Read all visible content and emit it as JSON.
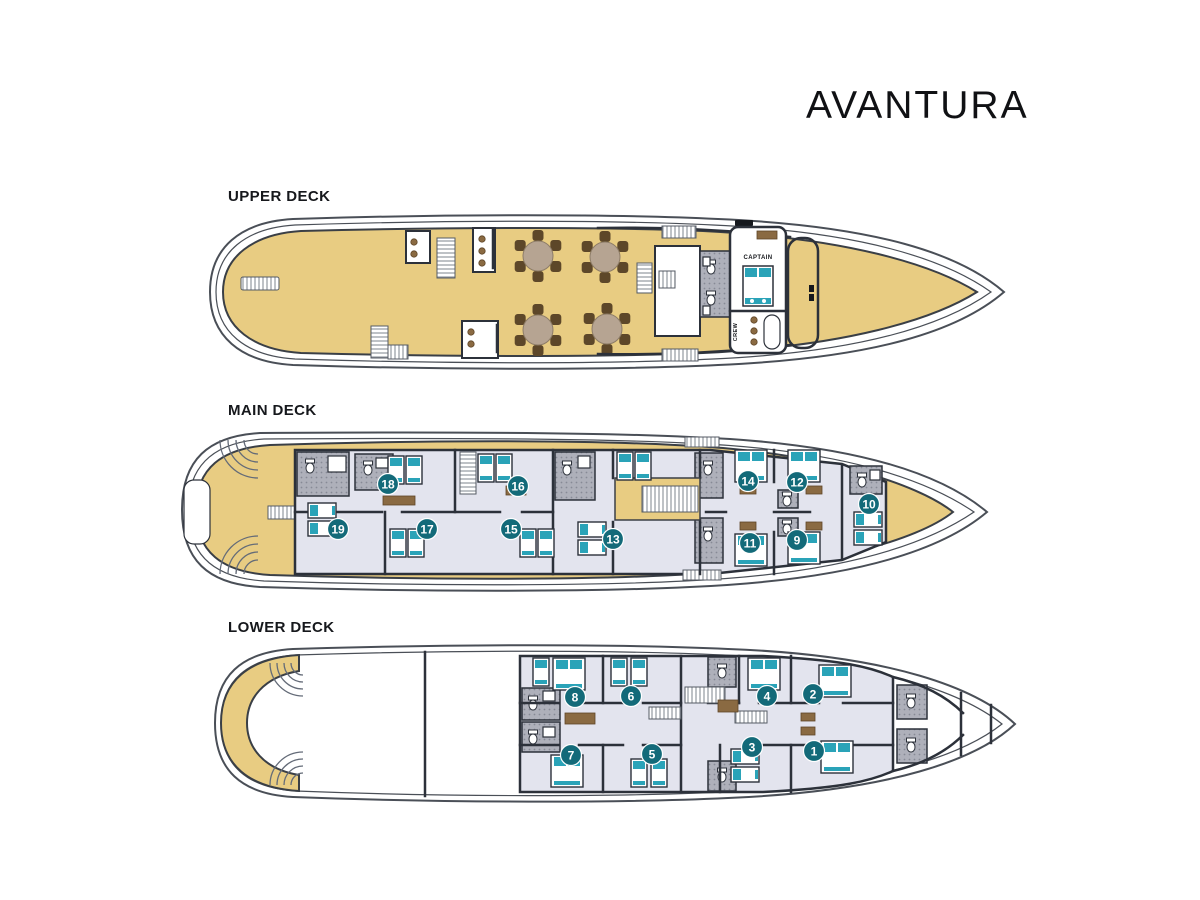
{
  "title": "AVANTURA",
  "decks": {
    "upper": {
      "label": "UPPER DECK",
      "rooms": {
        "captain": "CAPTAIN",
        "crew": "CREW"
      }
    },
    "main": {
      "label": "MAIN DECK",
      "cabin_numbers": [
        "18",
        "16",
        "19",
        "17",
        "15",
        "13",
        "14",
        "12",
        "11",
        "9",
        "10"
      ]
    },
    "lower": {
      "label": "LOWER DECK",
      "cabin_numbers": [
        "8",
        "6",
        "4",
        "2",
        "7",
        "5",
        "3",
        "1"
      ]
    }
  },
  "colors": {
    "wood": "#e8cc82",
    "floor": "#e3e4ee",
    "teal": "#2aa3b8",
    "badge": "#136a79",
    "hull": "#4a4f57",
    "brown": "#8a6a42"
  }
}
